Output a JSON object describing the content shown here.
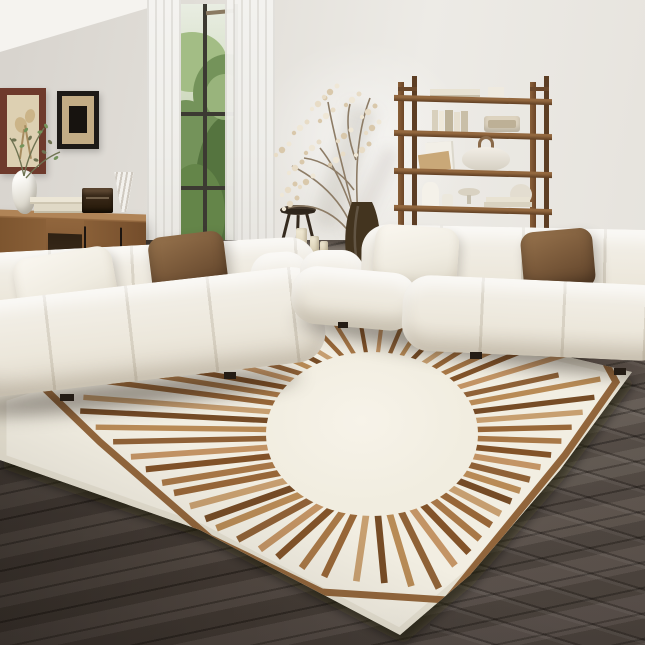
{
  "scene": {
    "description": "Bright modern living room: two white tufted modular sofas with brown and cream throw pillows, a walnut sideboard with decor, a tall wooden ladder shelving unit with books and ceramics, dried branch arrangement in a dark floor vase, small wooden stool with pillar candles, tall window with sheer white curtains and green foliage outside, two framed artworks, and a large ivory area rug with a brown sunburst ray pattern and angular border on dark wood plank flooring.",
    "objects": [
      "wall",
      "ceiling",
      "window",
      "sheer-curtains",
      "greenery-view",
      "framed-artwork-large",
      "framed-artwork-small",
      "wooden-sideboard",
      "sculptural-vase",
      "olive-branch",
      "stacked-trays",
      "vintage-radio",
      "cone-vase",
      "ladder-shelf-unit",
      "shelf-books",
      "shelf-speaker",
      "dome-lamp",
      "pitcher",
      "footed-bowl",
      "dried-branch-arrangement",
      "dark-floor-vase",
      "wooden-stool",
      "pillar-candles",
      "magazine-stack",
      "modular-sofa-left",
      "modular-sofa-right",
      "cream-throw-pillow",
      "brown-throw-pillow",
      "sunburst-area-rug",
      "dark-wood-floor"
    ]
  },
  "palette": {
    "wall_left": "#dcd8d2",
    "wall_right": "#eceae5",
    "ceiling": "#f5f3ef",
    "window_frame": "#3c3a32",
    "greenery_dark": "#55743f",
    "greenery_mid": "#74935a",
    "greenery_light": "#a3bd85",
    "curtain": "#f2f1ee",
    "frame1": "#6e3a2c",
    "mat1": "#ddd0b2",
    "frame2": "#1d1a17",
    "mat2": "#c3ac85",
    "art2": "#17130f",
    "wood_cabinet": "#8a6038",
    "wood_shelf": "#7b5534",
    "sofa": "#f4f1ea",
    "pillow_brown": "#7d5c3c",
    "candle": "#ece4cf",
    "branch": "#8d7c66",
    "blossom": "#e8dcc6",
    "vase_dark": "#43341f",
    "stool": "#3a2f25",
    "floor_dark": "#4a413a",
    "rug_base": "#f2eee2",
    "rug_edge": "#e6e1d2",
    "rug_border": "#8a5a2e"
  },
  "rug": {
    "geometry": {
      "cx": 372,
      "cy": 434,
      "rx": 106,
      "ry": 82,
      "ray_count": 56,
      "reach_left": 340,
      "reach_right": 262,
      "reach_up": 150,
      "reach_down": 172
    },
    "ray_colors": [
      "#a4713f",
      "#7c4a1f",
      "#c08f5e",
      "#8a5a2e",
      "#b5854f",
      "#6f431c",
      "#c49a6a",
      "#935f2f"
    ],
    "border_points": "42,386 100,442 210,538 322,592 447,600 565,455 616,382 592,338",
    "clip_points": "0,396 310,296 632,372 560,470 470,575 400,635 200,530 0,460"
  }
}
